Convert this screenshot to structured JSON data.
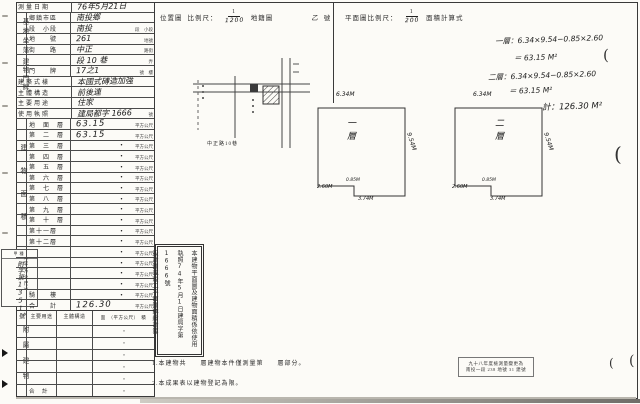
{
  "left_table": {
    "groups": {
      "site": "基地坐落",
      "address": "建物門牌",
      "area": "建物面積",
      "area_unit": "（平方公尺）",
      "attached": "附屬建物"
    },
    "rows": [
      {
        "label": "測量日期",
        "value": "76年5月21日",
        "suffix": "",
        "full": true
      },
      {
        "label": "鄉鎮市區",
        "value": "南投鄉",
        "suffix": ""
      },
      {
        "label": "段　小段",
        "value": "南投",
        "suffix": "段　小段"
      },
      {
        "label": "地　　號",
        "value": "261",
        "suffix": "地號"
      },
      {
        "label": "街　　路",
        "value": "中正",
        "suffix": "路街"
      },
      {
        "label": "",
        "value": "段 10 巷",
        "suffix": "弄"
      },
      {
        "label": "門　　牌",
        "value": "17之1",
        "suffix": "號　樓"
      },
      {
        "label": "建築式樣",
        "value": "本國式磚造加強",
        "suffix": "",
        "full": true
      },
      {
        "label": "主體構造",
        "value": "前後連",
        "suffix": "",
        "full": true
      },
      {
        "label": "主要用途",
        "value": "住家",
        "suffix": "",
        "full": true
      },
      {
        "label": "使用執照",
        "value": "建局都字 1666",
        "suffix": "號",
        "full": true
      }
    ],
    "area_rows": [
      {
        "label": "地　面　層",
        "value": "63.15",
        "hw": true
      },
      {
        "label": "第　二　層",
        "value": "63.15",
        "hw": true
      },
      {
        "label": "第　三　層",
        "value": "・"
      },
      {
        "label": "第　四　層",
        "value": "・"
      },
      {
        "label": "第　五　層",
        "value": "・"
      },
      {
        "label": "第　六　層",
        "value": "・"
      },
      {
        "label": "第　七　層",
        "value": "・"
      },
      {
        "label": "第　八　層",
        "value": "・"
      },
      {
        "label": "第　九　層",
        "value": "・"
      },
      {
        "label": "第　十　層",
        "value": "・"
      },
      {
        "label": "第十一層",
        "value": "・"
      },
      {
        "label": "第十二層",
        "value": "・"
      },
      {
        "label": "",
        "value": "・"
      },
      {
        "label": "",
        "value": "・"
      },
      {
        "label": "",
        "value": "・"
      },
      {
        "label": "",
        "value": "・"
      },
      {
        "label": "騎　　樓",
        "value": "・"
      },
      {
        "label": "合　　計",
        "value": "126.30",
        "hw": true
      }
    ],
    "unit_suffix": "平方公尺"
  },
  "attached_table": {
    "headers": {
      "use": "主要用途",
      "structure": "主體構造",
      "area": "面　（平方公尺）　積"
    },
    "rows": [
      {
        "use": "",
        "structure": "",
        "area": "・"
      },
      {
        "use": "",
        "structure": "",
        "area": "・"
      },
      {
        "use": "",
        "structure": "",
        "area": "・"
      },
      {
        "use": "",
        "structure": "",
        "area": "・"
      },
      {
        "use": "",
        "structure": "",
        "area": "・"
      },
      {
        "use": "合　計",
        "structure": "",
        "area": "・"
      }
    ]
  },
  "margin_box": {
    "header": "甲種",
    "number": "附字第1351號"
  },
  "location_header": {
    "title": "位置圖",
    "scale_label": "比例尺：",
    "num": "1",
    "den": "1200",
    "map": "地籍圖",
    "sheet": "乙",
    "unit": "號"
  },
  "plan_header": {
    "label": "平面圖比例尺：",
    "num": "1",
    "den": "200",
    "calc": "面積計算式"
  },
  "calc": {
    "l1": "一層：6.34×9.54−0.85×2.60",
    "l2": "＝ 63.15 M²",
    "l3": "二層：6.34×9.54−0.85×2.60",
    "l4": "＝ 63.15 M²",
    "total": "計：126.30 M²"
  },
  "plans": [
    {
      "name": "一層",
      "top": "6.34M",
      "side": "9.54M",
      "notch_w": "2.60M",
      "notch_d": "0.85M",
      "bottom": "3.74M"
    },
    {
      "name": "二層",
      "top": "6.34M",
      "side": "9.54M",
      "notch_w": "2.60M",
      "notch_d": "0.85M",
      "bottom": "3.74M"
    }
  ],
  "sketch": {
    "street": "中正路10巷"
  },
  "statement": {
    "col_a": "本建物平面圖及建物面積係依使用",
    "col_b": "執照74年5月1日建局字第1666號",
    "col_c": "設計圖或竣工平面圖轉繪計算"
  },
  "notes": {
    "n1": "1.本建物共　　層建物本件僅測量第　　層部分。",
    "n2": "2.本成果表以建物登記為限。"
  },
  "stamp": {
    "l1": "九十八年度檢測量變更為",
    "l2": "南投一段 238 地號 31 建號"
  }
}
